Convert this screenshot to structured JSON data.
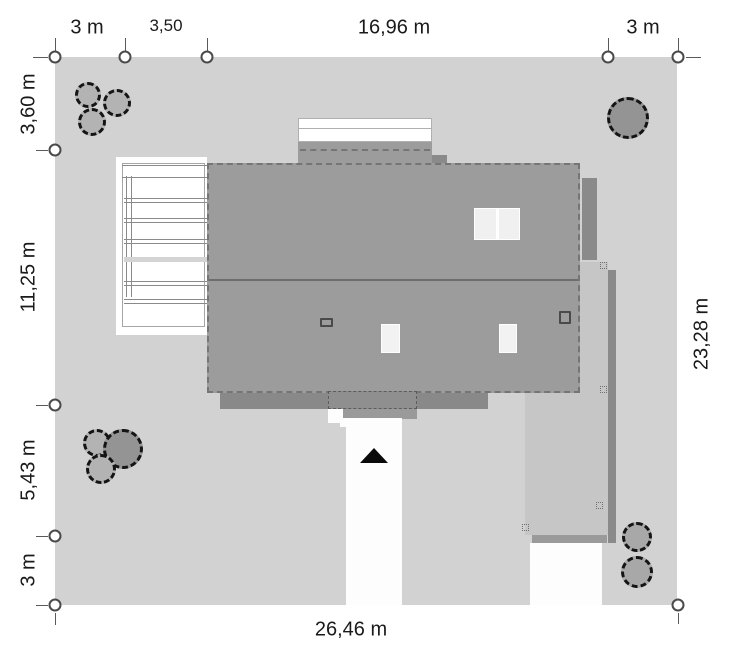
{
  "drawing": {
    "type": "site-plan",
    "colors": {
      "plot": "#d2d2d2",
      "roof": "#9c9c9c",
      "dark_gray": "#898989",
      "terrace": "#c6c6c6",
      "paving_white": "#fdfdfd",
      "text": "#1a1a1a"
    }
  },
  "dimensions": {
    "top": {
      "setback_left": "3 m",
      "offset": "3,50",
      "house_width": "16,96 m",
      "setback_right": "3 m"
    },
    "left": {
      "setback_top": "3,60 m",
      "house_depth": "11,25 m",
      "garden_depth": "5,43 m",
      "setback_bottom": "3 m"
    },
    "right": {
      "plot_depth": "23,28 m"
    },
    "bottom": {
      "plot_width": "26,46 m"
    }
  }
}
